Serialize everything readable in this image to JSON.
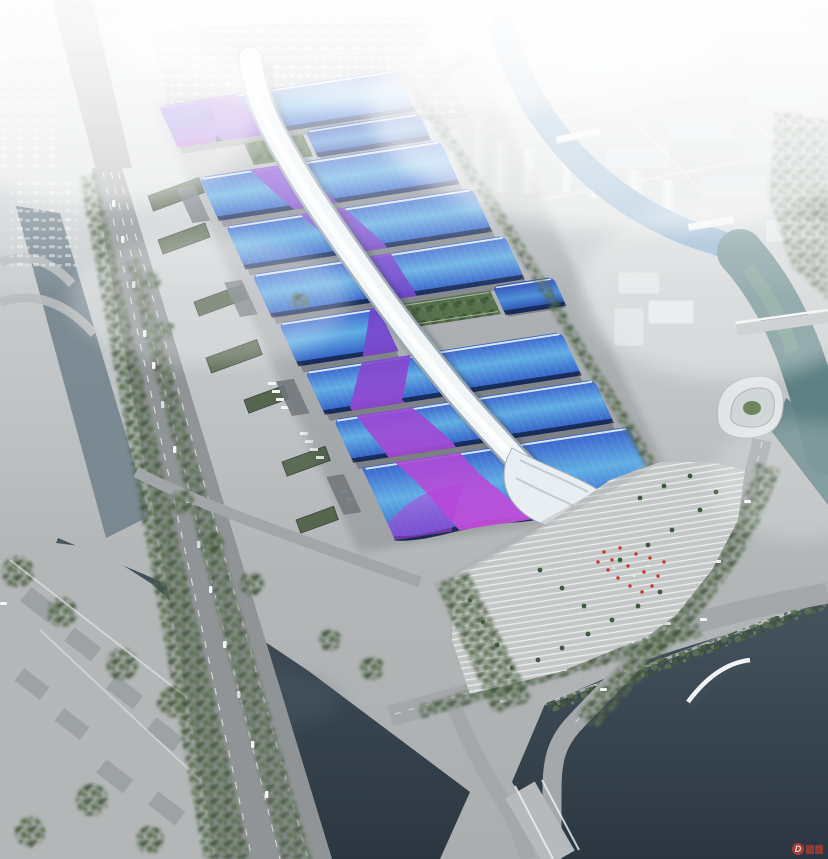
{
  "image": {
    "description": "Aerial architectural rendering of a large exhibition and convention center complex with blue wave roofs, a silver central spine walkway, surrounding roads, rivers and hazy city skyline",
    "width_px": 828,
    "height_px": 859
  },
  "watermark": {
    "symbol": "D",
    "color": "#c23b31"
  },
  "palette": {
    "fog_white": "#ffffff",
    "ground_light": "#dfe3e5",
    "ground_dark": "#aaaeaf",
    "city_block": "#dde3e6",
    "road": "#97999b",
    "highway": "#909496",
    "river_blue": "#7aa2c5",
    "river_green": "#5c8083",
    "water_dark_top": "#46545f",
    "water_dark_bottom": "#2b3640",
    "canal_gray": "#73838d",
    "tree_dark": "#46593f",
    "tree_mid": "#5b7050",
    "hall_rim": "#eaf4fb",
    "hall_blue_top": "#3a63cc",
    "hall_blue_mid": "#62aee4",
    "hall_blue_deep": "#2d55c4",
    "hall_shadow": "#101c36",
    "ribbon_magenta": "#c94fdd",
    "ribbon_mid": "#9a50d8",
    "ribbon_violet": "#7046cc",
    "spine_light": "#eef3f6",
    "spine_edge": "#9aa8b2",
    "plaza": "#c6c9c9",
    "plaza_stripe": "#ffffff",
    "accent_red": "#cc352c"
  }
}
